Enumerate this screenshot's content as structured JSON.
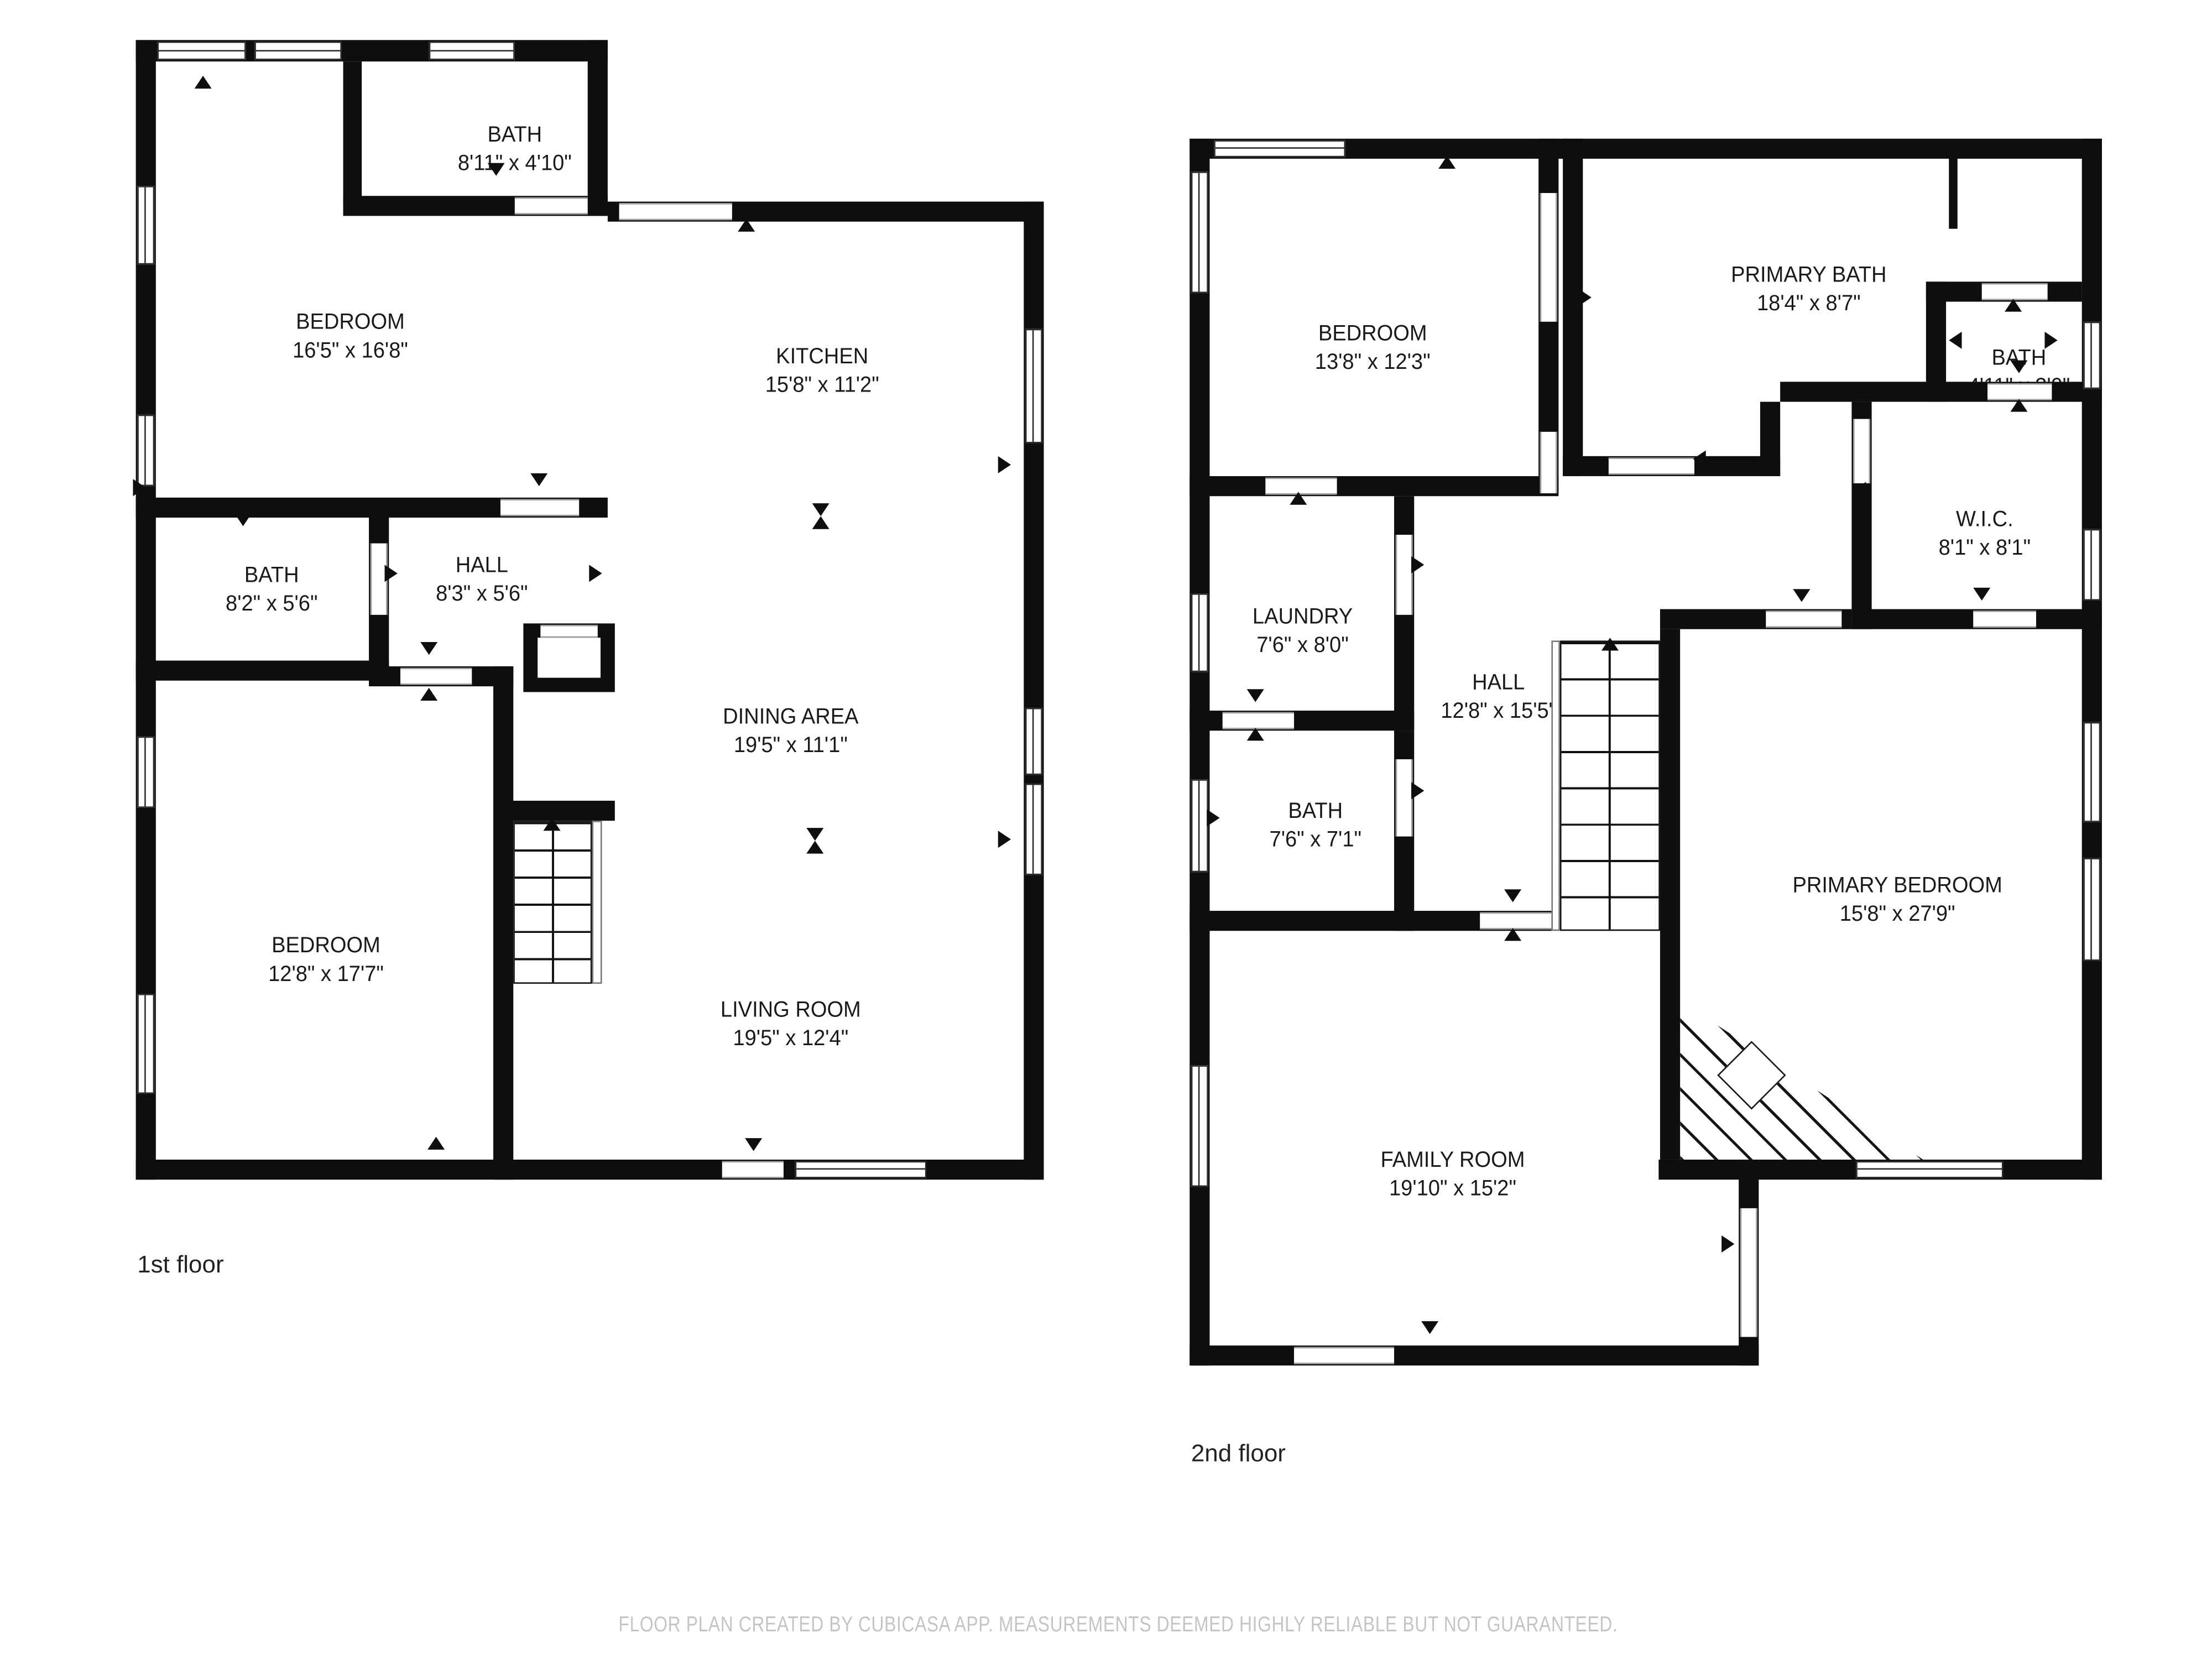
{
  "colors": {
    "wall": "#0e0e0e",
    "label": "#191919",
    "muted": "#c4c4c4",
    "background": "#ffffff"
  },
  "floors": [
    {
      "label": "1st floor",
      "rooms": [
        {
          "key": "bath-upper",
          "name": "BATH",
          "dims": "8'11\" x 4'10\""
        },
        {
          "key": "bedroom-front",
          "name": "BEDROOM",
          "dims": "16'5\" x 16'8\""
        },
        {
          "key": "kitchen",
          "name": "KITCHEN",
          "dims": "15'8\" x 11'2\""
        },
        {
          "key": "bath-hall",
          "name": "BATH",
          "dims": "8'2\" x 5'6\""
        },
        {
          "key": "hall",
          "name": "HALL",
          "dims": "8'3\" x 5'6\""
        },
        {
          "key": "dining-area",
          "name": "DINING AREA",
          "dims": "19'5\" x 11'1\""
        },
        {
          "key": "bedroom-rear",
          "name": "BEDROOM",
          "dims": "12'8\" x 17'7\""
        },
        {
          "key": "living-room",
          "name": "LIVING ROOM",
          "dims": "19'5\" x 12'4\""
        }
      ]
    },
    {
      "label": "2nd floor",
      "rooms": [
        {
          "key": "bedroom",
          "name": "BEDROOM",
          "dims": "13'8\" x 12'3\""
        },
        {
          "key": "primary-bath",
          "name": "PRIMARY BATH",
          "dims": "18'4\" x 8'7\""
        },
        {
          "key": "bath-small",
          "name": "BATH",
          "dims": "4'11\" x 3'0\""
        },
        {
          "key": "wic",
          "name": "W.I.C.",
          "dims": "8'1\" x 8'1\""
        },
        {
          "key": "laundry",
          "name": "LAUNDRY",
          "dims": "7'6\" x 8'0\""
        },
        {
          "key": "hall",
          "name": "HALL",
          "dims": "12'8\" x 15'5\""
        },
        {
          "key": "bath",
          "name": "BATH",
          "dims": "7'6\" x 7'1\""
        },
        {
          "key": "primary-bedroom",
          "name": "PRIMARY BEDROOM",
          "dims": "15'8\" x 27'9\""
        },
        {
          "key": "family-room",
          "name": "FAMILY ROOM",
          "dims": "19'10\" x 15'2\""
        }
      ]
    }
  ],
  "footer": {
    "disclaimer": "FLOOR PLAN CREATED BY CUBICASA APP. MEASUREMENTS DEEMED HIGHLY RELIABLE BUT NOT GUARANTEED."
  }
}
